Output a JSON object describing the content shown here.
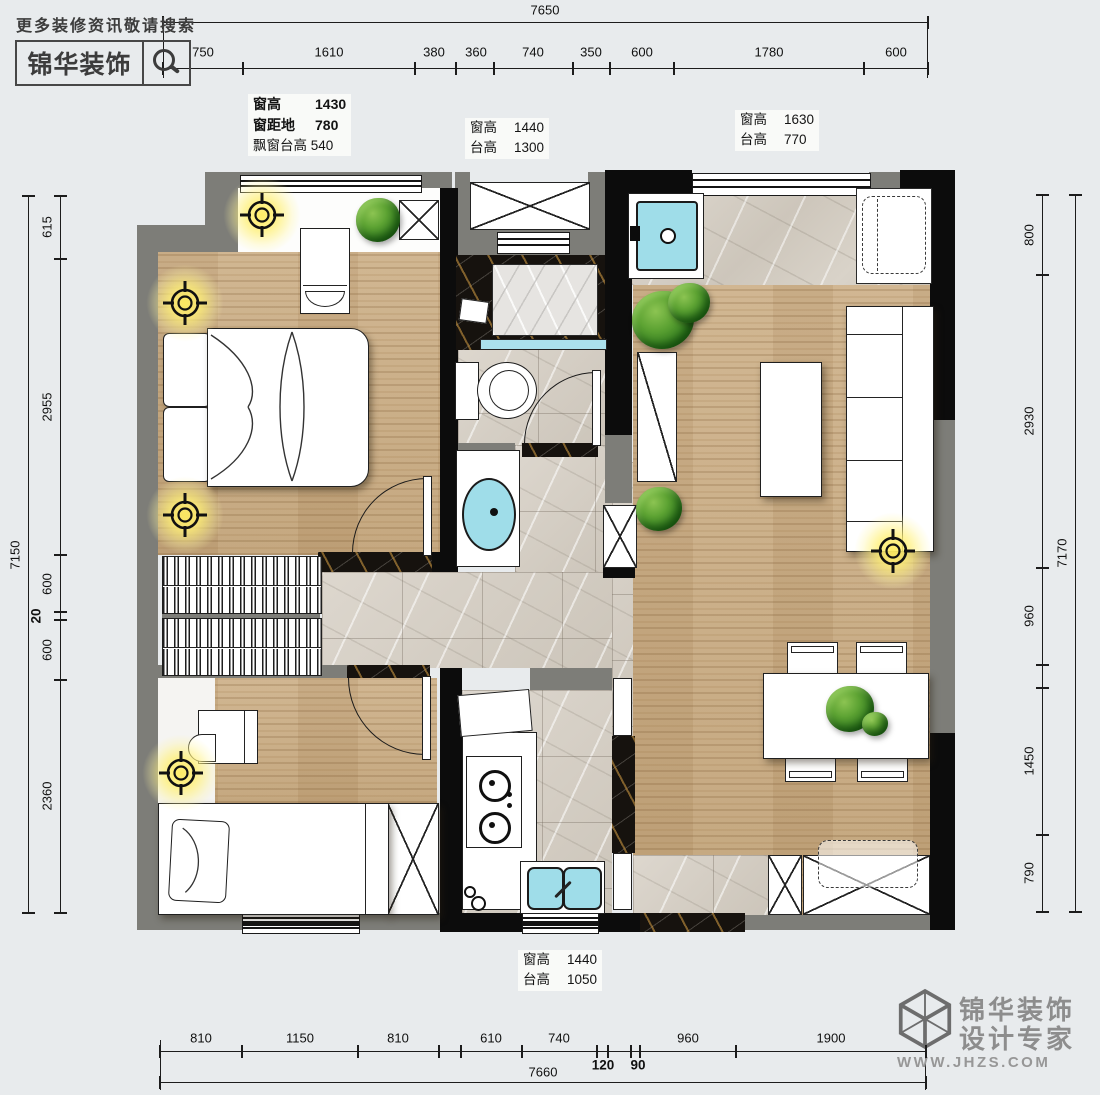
{
  "header": {
    "promo": "更多装修资讯敬请搜索",
    "brand": "锦华装饰"
  },
  "annotations": {
    "bay": {
      "rows": [
        {
          "k": "窗高",
          "v": "1430"
        },
        {
          "k": "窗距地",
          "v": "780"
        }
      ],
      "note_k": "飘窗台高",
      "note_v": "540"
    },
    "bath": {
      "rows": [
        {
          "k": "窗高",
          "v": "1440"
        },
        {
          "k": "台高",
          "v": "1300"
        }
      ]
    },
    "balcony": {
      "rows": [
        {
          "k": "窗高",
          "v": "1630"
        },
        {
          "k": "台高",
          "v": "770"
        }
      ]
    },
    "kitchen": {
      "rows": [
        {
          "k": "窗高",
          "v": "1440"
        },
        {
          "k": "台高",
          "v": "1050"
        }
      ]
    }
  },
  "dims": {
    "top": {
      "total": "7650",
      "segments": [
        "750",
        "1610",
        "380",
        "360",
        "740",
        "350",
        "600",
        "1780",
        "600"
      ]
    },
    "bottom": {
      "total": "7660",
      "segments": [
        "810",
        "1150",
        "810",
        "610",
        "740",
        "120",
        "90",
        "960",
        "1900"
      ]
    },
    "left": {
      "total": "7150",
      "segments": [
        "615",
        "2955",
        "600",
        "20",
        "600",
        "2360"
      ]
    },
    "right": {
      "total": "7170",
      "segments": [
        "800",
        "2930",
        "960",
        "1450",
        "790"
      ]
    }
  },
  "footer": {
    "brand1": "锦华装饰",
    "brand2": "设计专家",
    "url": "WWW.JHZS.COM"
  }
}
